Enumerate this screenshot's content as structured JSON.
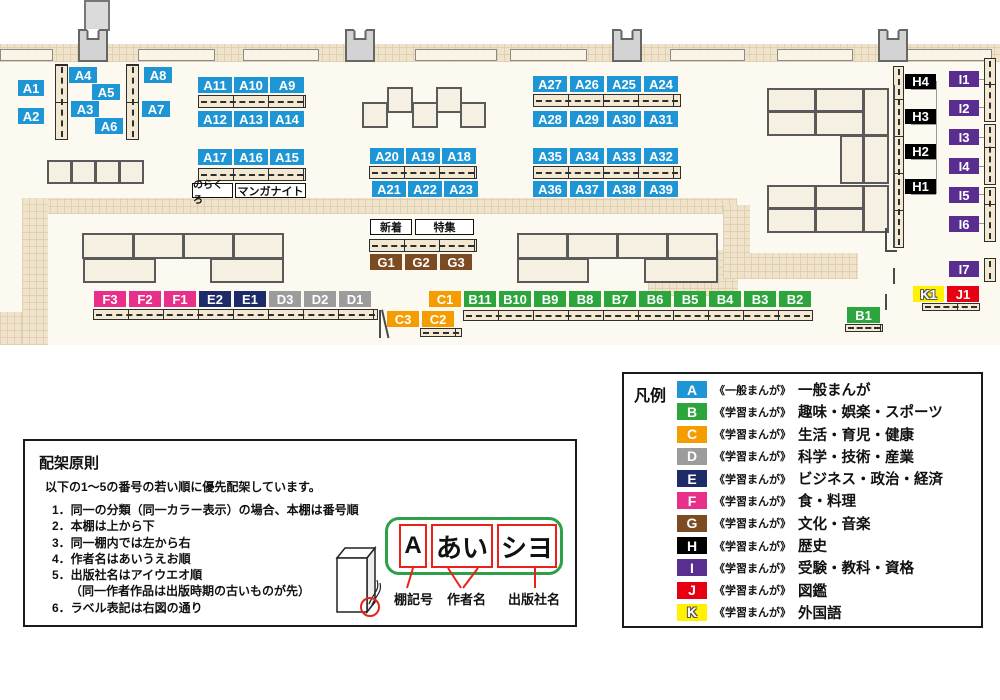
{
  "legend": {
    "heading": "凡例",
    "items": [
      {
        "code": "A",
        "series": "《一般まんが》",
        "category": "一般まんが",
        "color": "#1E95D4"
      },
      {
        "code": "B",
        "series": "《学習まんが》",
        "category": "趣味・娯楽・スポーツ",
        "color": "#2BA53C"
      },
      {
        "code": "C",
        "series": "《学習まんが》",
        "category": "生活・育児・健康",
        "color": "#F59C00"
      },
      {
        "code": "D",
        "series": "《学習まんが》",
        "category": "科学・技術・産業",
        "color": "#9C9C9C"
      },
      {
        "code": "E",
        "series": "《学習まんが》",
        "category": "ビジネス・政治・経済",
        "color": "#1D2B69"
      },
      {
        "code": "F",
        "series": "《学習まんが》",
        "category": "食・料理",
        "color": "#E8308A"
      },
      {
        "code": "G",
        "series": "《学習まんが》",
        "category": "文化・音楽",
        "color": "#7C4B22"
      },
      {
        "code": "H",
        "series": "《学習まんが》",
        "category": "歴史",
        "color": "#000000"
      },
      {
        "code": "I",
        "series": "《学習まんが》",
        "category": "受験・教科・資格",
        "color": "#5A2E91"
      },
      {
        "code": "J",
        "series": "《学習まんが》",
        "category": "図鑑",
        "color": "#E60012"
      },
      {
        "code": "K",
        "series": "《学習まんが》",
        "category": "外国語",
        "color": "#FFF100"
      }
    ]
  },
  "principles": {
    "title": "配架原則",
    "intro": "以下の1～5の番号の若い順に優先配架しています。",
    "rules": [
      "1．同一の分類（同一カラー表示）の場合、本棚は番号順",
      "2．本棚は上から下",
      "3．同一棚内では左から右",
      "4．作者名はあいうえお順",
      "5．出版社名はアイウエオ順",
      "　　（同一作者作品は出版時期の古いものが先）",
      "6．ラベル表記は右図の通り"
    ],
    "label_example": {
      "shelf_code": "A",
      "author": "あい",
      "publisher": "シヨ",
      "captions": [
        "棚記号",
        "作者名",
        "出版社名"
      ]
    }
  },
  "map": {
    "signs": {
      "norakuro": "のらくろ",
      "manganight": "マンガナイト",
      "shinchaku": "新着",
      "tokushu": "特集"
    },
    "singles": {
      "a1": "A1",
      "a2": "A2",
      "a3": "A3",
      "a4": "A4",
      "a5": "A5",
      "a6": "A6",
      "a7": "A7",
      "a8": "A8",
      "b1": "B1",
      "i7": "I7",
      "k1": "K1",
      "j1": "J1"
    },
    "rows": {
      "a11": [
        "A11",
        "A10",
        "A9"
      ],
      "a12": [
        "A12",
        "A13",
        "A14"
      ],
      "a17": [
        "A17",
        "A16",
        "A15"
      ],
      "a20": [
        "A20",
        "A19",
        "A18"
      ],
      "a21": [
        "A21",
        "A22",
        "A23"
      ],
      "a27": [
        "A27",
        "A26",
        "A25",
        "A24"
      ],
      "a28": [
        "A28",
        "A29",
        "A30",
        "A31"
      ],
      "a35": [
        "A35",
        "A34",
        "A33",
        "A32"
      ],
      "a36": [
        "A36",
        "A37",
        "A38",
        "A39"
      ],
      "g": [
        "G1",
        "G2",
        "G3"
      ],
      "c": [
        "C3",
        "C2"
      ],
      "fed": [
        {
          "t": "F3",
          "c": "F"
        },
        {
          "t": "F2",
          "c": "F"
        },
        {
          "t": "F1",
          "c": "F"
        },
        {
          "t": "E2",
          "c": "E"
        },
        {
          "t": "E1",
          "c": "E"
        },
        {
          "t": "D3",
          "c": "D"
        },
        {
          "t": "D2",
          "c": "D"
        },
        {
          "t": "D1",
          "c": "D"
        }
      ],
      "b": [
        {
          "t": "C1",
          "c": "C"
        },
        {
          "t": "B11",
          "c": "B"
        },
        {
          "t": "B10",
          "c": "B"
        },
        {
          "t": "B9",
          "c": "B"
        },
        {
          "t": "B8",
          "c": "B"
        },
        {
          "t": "B7",
          "c": "B"
        },
        {
          "t": "B6",
          "c": "B"
        },
        {
          "t": "B5",
          "c": "B"
        },
        {
          "t": "B4",
          "c": "B"
        },
        {
          "t": "B3",
          "c": "B"
        },
        {
          "t": "B2",
          "c": "B"
        }
      ]
    },
    "h_col": [
      "H4",
      "H3",
      "H2",
      "H1"
    ],
    "i_col": [
      "I1",
      "I2",
      "I3",
      "I4",
      "I5",
      "I6"
    ]
  }
}
